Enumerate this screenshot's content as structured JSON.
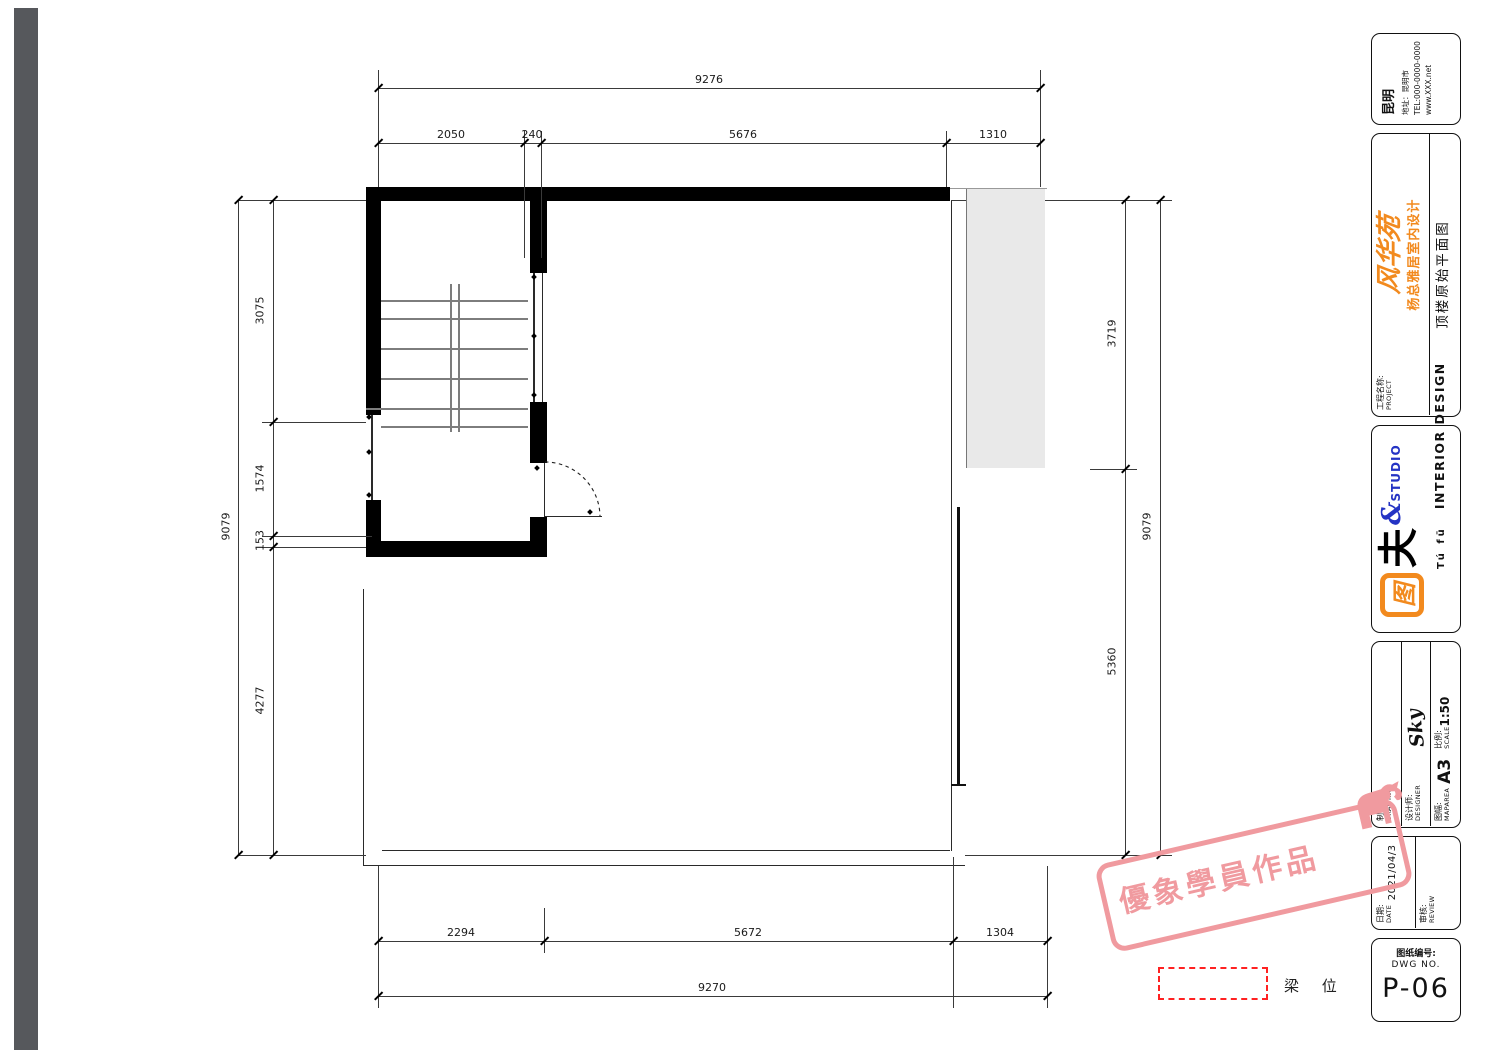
{
  "dims": {
    "top": {
      "overall": "9276",
      "segments": [
        "2050",
        "240",
        "5676",
        "1310"
      ]
    },
    "bottom": {
      "overall": "9270",
      "segments": [
        "2294",
        "5672",
        "1304"
      ]
    },
    "left": {
      "overall": "9079",
      "segments": [
        "3075",
        "1574",
        "153",
        "4277"
      ]
    },
    "right": {
      "overall": "9079",
      "segments": [
        "3719",
        "5360"
      ]
    }
  },
  "legend": {
    "beam": "梁 位"
  },
  "stamp": {
    "text": "優象學員作品",
    "color": "#f09a9f"
  },
  "colors": {
    "brand_orange": "#f28a1e",
    "studio_blue": "#2433c4",
    "legend_red": "#ff2222"
  },
  "tb": {
    "company": {
      "name": "昆明",
      "addr": "地址：昆明市",
      "tel": "TEL:000-0000-0000",
      "web": "www.XXX.net"
    },
    "project": {
      "cn": "工程名称:",
      "en": "PROJECT",
      "script": "风华苑",
      "name": "杨总雅居室内设计",
      "title": "顶楼原始平面图"
    },
    "logo": {
      "mark": "图",
      "fu": "夫",
      "amp": "&",
      "studio": "STUDIO",
      "pinyin": "Tú fū",
      "type": "INTERIOR DESIGN"
    },
    "rows": {
      "drawing_cn": "制图:",
      "drawing_en": "DRAWING",
      "designer_cn": "设计师:",
      "designer_en": "DESIGNER",
      "designer_val": "Sky",
      "maparea_cn": "图幅:",
      "maparea_en": "MAPAREA",
      "maparea_val": "A3",
      "scale_cn": "比例:",
      "scale_en": "SCALE",
      "scale_val": "1:50",
      "date_cn": "日期:",
      "date_en": "DATE",
      "date_val": "2021/04/3",
      "review_cn": "审核:",
      "review_en": "REVIEW",
      "dwg_cn": "图纸编号:",
      "dwg_en": "DWG NO.",
      "dwg_val": "P-06"
    }
  }
}
